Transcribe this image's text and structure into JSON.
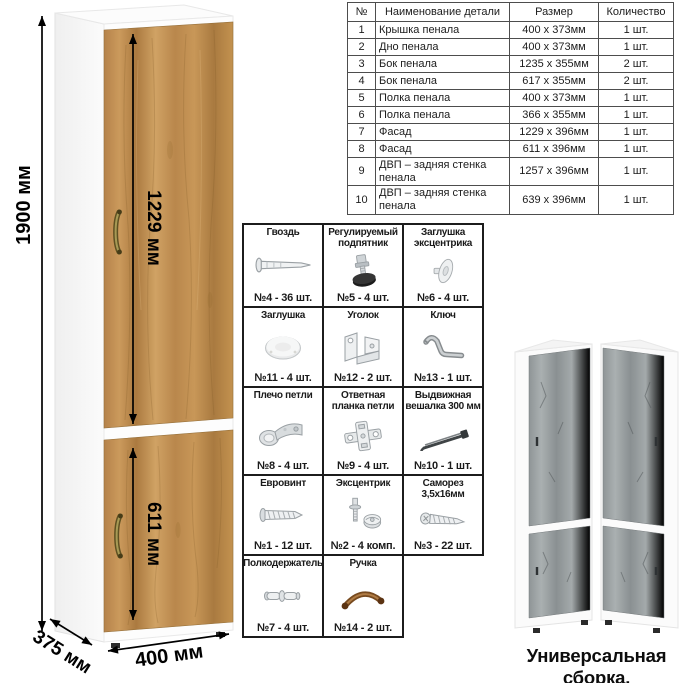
{
  "parts_table": {
    "headers": [
      "№",
      "Наименование детали",
      "Размер",
      "Количество"
    ],
    "rows": [
      [
        "1",
        "Крышка пенала",
        "400 х 373мм",
        "1 шт."
      ],
      [
        "2",
        "Дно пенала",
        "400 х 373мм",
        "1 шт."
      ],
      [
        "3",
        "Бок пенала",
        "1235 х 355мм",
        "2 шт."
      ],
      [
        "4",
        "Бок пенала",
        "617 х 355мм",
        "2 шт."
      ],
      [
        "5",
        "Полка пенала",
        "400 х 373мм",
        "1 шт."
      ],
      [
        "6",
        "Полка пенала",
        "366 х 355мм",
        "1 шт."
      ],
      [
        "7",
        "Фасад",
        "1229 х 396мм",
        "1 шт."
      ],
      [
        "8",
        "Фасад",
        "611 х 396мм",
        "1 шт."
      ],
      [
        "9",
        "ДВП – задняя стенка пенала",
        "1257 х 396мм",
        "1 шт."
      ],
      [
        "10",
        "ДВП – задняя стенка пенала",
        "639 х 396мм",
        "1 шт."
      ]
    ]
  },
  "dimensions": {
    "height": "1900 мм",
    "upper_door": "1229 мм",
    "lower_door": "611 мм",
    "depth": "375 мм",
    "width": "400 мм"
  },
  "hardware": {
    "cells": [
      {
        "name": "Гвоздь",
        "count": "№4 - 36 шт.",
        "icon": "nail-icon"
      },
      {
        "name": "Регулируемый подпятник",
        "count": "№5 - 4 шт.",
        "icon": "adjustable-foot-icon"
      },
      {
        "name": "Заглушка эксцентрика",
        "count": "№6 - 4 шт.",
        "icon": "cam-cover-icon"
      },
      {
        "name": "Заглушка",
        "count": "№11 - 4 шт.",
        "icon": "cover-cap-icon"
      },
      {
        "name": "Уголок",
        "count": "№12 - 2 шт.",
        "icon": "angle-bracket-icon"
      },
      {
        "name": "Ключ",
        "count": "№13 - 1 шт.",
        "icon": "hex-key-icon"
      },
      {
        "name": "Плечо петли",
        "count": "№8 - 4 шт.",
        "icon": "hinge-arm-icon"
      },
      {
        "name": "Ответная планка петли",
        "count": "№9 - 4 шт.",
        "icon": "hinge-plate-icon"
      },
      {
        "name": "Выдвижная вешалка 300 мм",
        "count": "№10 - 1 шт.",
        "icon": "pullout-hanger-icon"
      },
      {
        "name": "Евровинт",
        "count": "№1 - 12 шт.",
        "icon": "confirmat-screw-icon"
      },
      {
        "name": "Эксцентрик",
        "count": "№2 - 4 комп.",
        "icon": "cam-lock-icon"
      },
      {
        "name": "Саморез 3,5х16мм",
        "count": "№3 - 22 шт.",
        "icon": "self-tapping-screw-icon"
      },
      {
        "name": "Полкодержатель",
        "count": "№7 - 4 шт.",
        "icon": "shelf-pin-icon"
      },
      {
        "name": "Ручка",
        "count": "№14 - 2 шт.",
        "icon": "handle-icon"
      }
    ]
  },
  "caption": "Универсальная сборка.",
  "colors": {
    "wood": "#c2914f",
    "wood_dark": "#a87a3e",
    "grey_wood": "#9aa0a2",
    "handle_bronze": "#857539",
    "carcass_white": "#fdfdfd"
  }
}
